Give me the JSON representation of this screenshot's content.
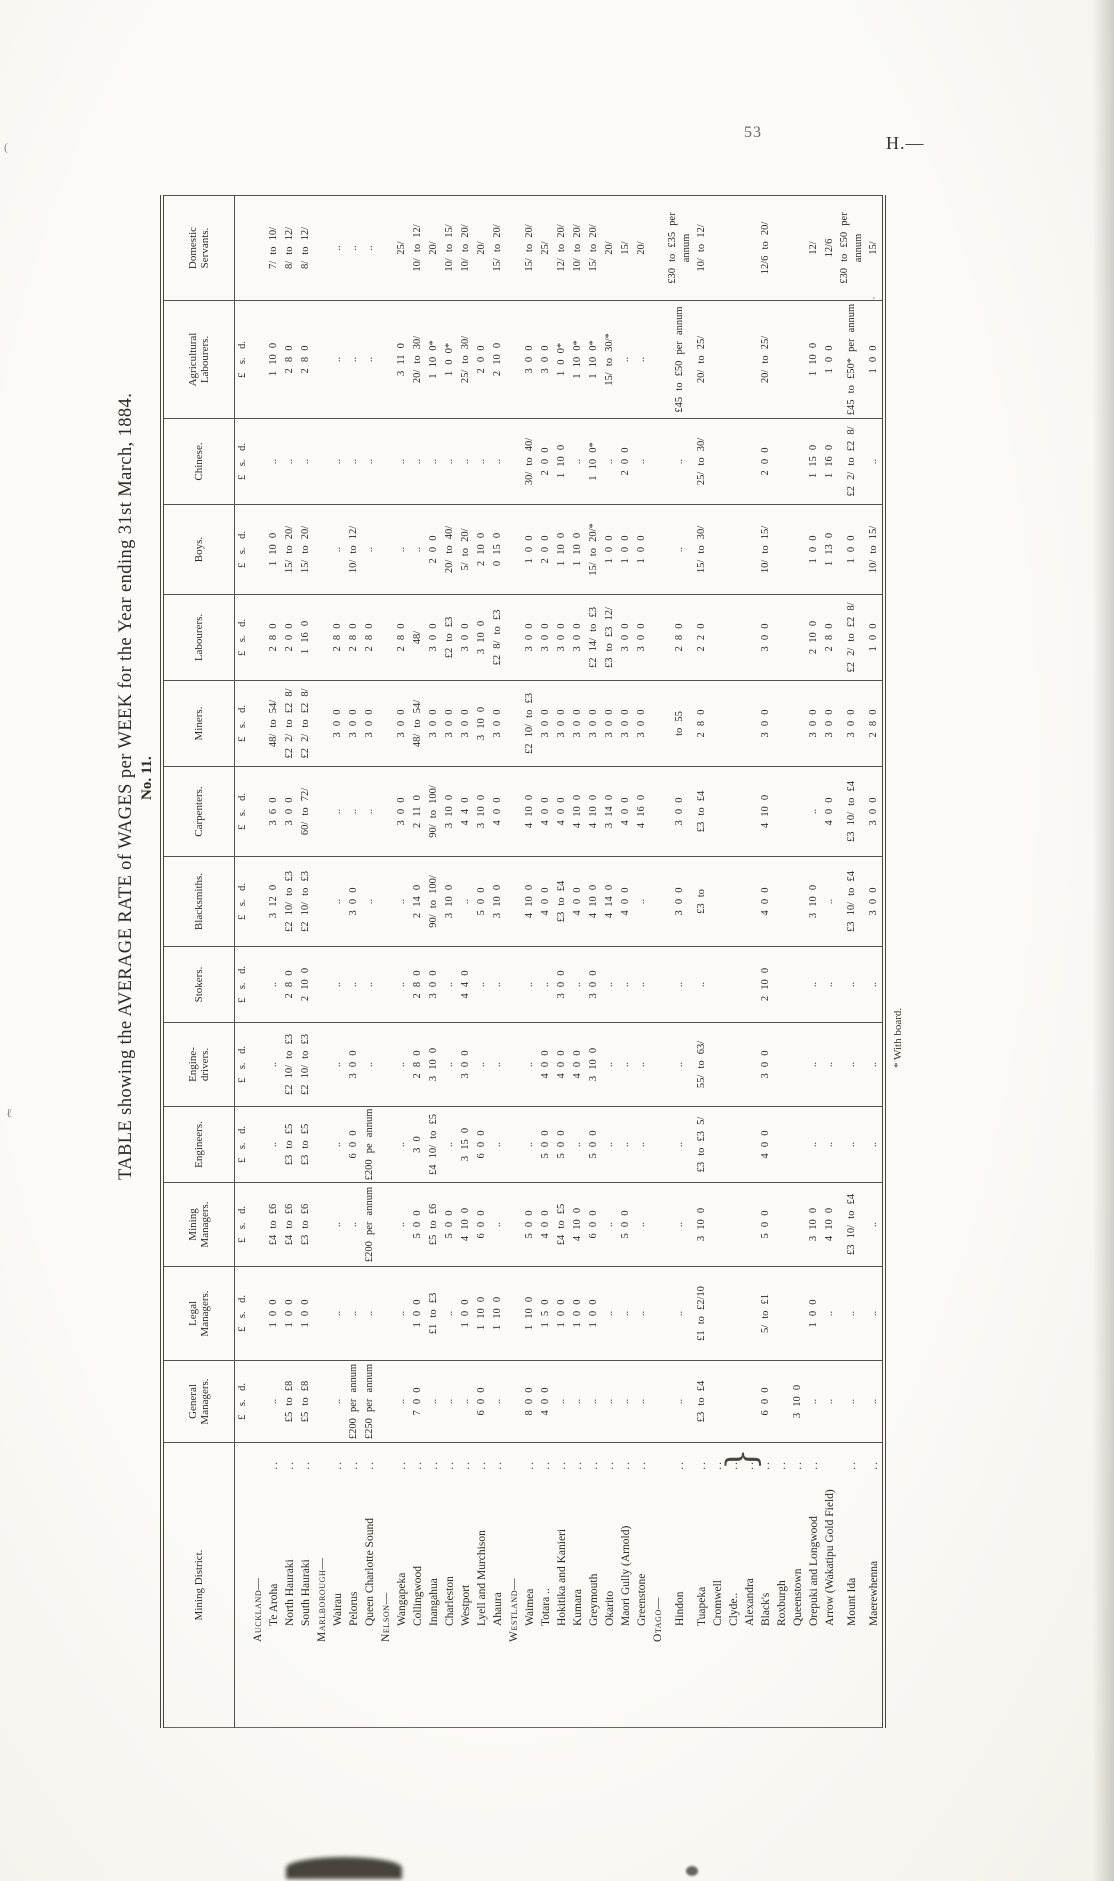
{
  "page": {
    "number": "53",
    "series_heading": "H.—",
    "footnote": "* With board."
  },
  "doc": {
    "table_no": "No. 11.",
    "title": "TABLE showing the AVERAGE RATE of WAGES per WEEK for the Year ending 31st March, 1884."
  },
  "table": {
    "columns": [
      {
        "label": "Mining District.",
        "sub": ""
      },
      {
        "label": "General\nManagers.",
        "sub": "£ s. d."
      },
      {
        "label": "Legal\nManagers.",
        "sub": "£ s. d."
      },
      {
        "label": "Mining\nManagers.",
        "sub": "£ s. d."
      },
      {
        "label": "Engineers.",
        "sub": "£ s. d."
      },
      {
        "label": "Engine-\ndrivers.",
        "sub": "£ s. d."
      },
      {
        "label": "Stokers.",
        "sub": "£ s. d."
      },
      {
        "label": "Blacksmiths.",
        "sub": "£ s. d."
      },
      {
        "label": "Carpenters.",
        "sub": "£ s. d."
      },
      {
        "label": "Miners.",
        "sub": "£ s. d."
      },
      {
        "label": "Labourers.",
        "sub": "£ s. d."
      },
      {
        "label": "Boys.",
        "sub": "£ s. d."
      },
      {
        "label": "Chinese.",
        "sub": "£ s. d."
      },
      {
        "label": "Agricultural\nLabourers.",
        "sub": "£ s. d."
      },
      {
        "label": "Domestic\nServants.",
        "sub": ""
      }
    ],
    "rows": [
      {
        "name": "Auckland—",
        "type": "section",
        "leader": "",
        "cells": [
          "",
          "",
          "",
          "",
          "",
          "",
          "",
          "",
          "",
          "",
          "",
          "",
          "",
          ""
        ]
      },
      {
        "name": "Te Aroha",
        "type": "district",
        "leader": "..",
        "cells": [
          "..",
          "1 0 0",
          "£4 to £6",
          "..",
          "..",
          "..",
          "3 12 0",
          "3 6 0",
          "48/ to 54/",
          "2 8 0",
          "1 10 0",
          "..",
          "1 10 0",
          "7/ to 10/"
        ]
      },
      {
        "name": "North Hauraki",
        "type": "district",
        "leader": "..",
        "cells": [
          "£5 to £8",
          "1 0 0",
          "£4 to £6",
          "£3 to £5",
          "£2 10/ to £3",
          "2 8 0",
          "£2 10/ to £3",
          "3 0 0",
          "£2 2/ to £2 8/",
          "2 0 0",
          "15/ to 20/",
          "..",
          "2 8 0",
          "8/ to 12/"
        ]
      },
      {
        "name": "South Hauraki",
        "type": "district",
        "leader": "..",
        "cells": [
          "£5 to £8",
          "1 0 0",
          "£3 to £6",
          "£3 to £5",
          "£2 10/ to £3",
          "2 10 0",
          "£2 10/ to £3",
          "60/ to 72/",
          "£2 2/ to £2 8/",
          "1 16 0",
          "15/ to 20/",
          "..",
          "2 8 0",
          "8/ to 12/"
        ]
      },
      {
        "name": "Marlborough—",
        "type": "section",
        "leader": "",
        "cells": [
          "",
          "",
          "",
          "",
          "",
          "",
          "",
          "",
          "",
          "",
          "",
          "",
          "",
          ""
        ]
      },
      {
        "name": "Wairau",
        "type": "district",
        "leader": "..",
        "cells": [
          "..",
          "..",
          "..",
          "..",
          "..",
          "..",
          "..",
          "..",
          "3 0 0",
          "2 8 0",
          "..",
          "..",
          "..",
          ".."
        ]
      },
      {
        "name": "Pelorus",
        "type": "district",
        "leader": "..",
        "cells": [
          "£200 per annum",
          "..",
          "..",
          "6 0 0",
          "3 0 0",
          "..",
          "3 0 0",
          "..",
          "3 0 0",
          "2 8 0",
          "10/ to 12/",
          "..",
          "..",
          ".."
        ]
      },
      {
        "name": "Queen Charlotte Sound",
        "type": "district",
        "leader": "..",
        "cells": [
          "£250 per annum",
          "..",
          "£200 per annum",
          "£200 pe annum",
          "..",
          "..",
          "..",
          "..",
          "3 0 0",
          "2 8 0",
          "..",
          "..",
          "..",
          ".."
        ]
      },
      {
        "name": "Nelson—",
        "type": "section",
        "leader": "",
        "cells": [
          "",
          "",
          "",
          "",
          "",
          "",
          "",
          "",
          "",
          "",
          "",
          "",
          "",
          ""
        ]
      },
      {
        "name": "Wangapeka",
        "type": "district",
        "leader": "..",
        "cells": [
          "..",
          "..",
          "..",
          "..",
          "..",
          "..",
          "..",
          "3 0 0",
          "3 0 0",
          "2 8 0",
          "..",
          "..",
          "3 11 0",
          "25/"
        ]
      },
      {
        "name": "Collingwood",
        "type": "district",
        "leader": "..",
        "cells": [
          "7 0 0",
          "1 0 0",
          "5 0 0",
          "3 0",
          "2 8 0",
          "2 8 0",
          "2 14 0",
          "2 11 0",
          "48/ to 54/",
          "48/",
          "..",
          "..",
          "20/ to 30/",
          "10/ to 12/"
        ]
      },
      {
        "name": "Inangahua",
        "type": "district",
        "leader": "..",
        "cells": [
          "..",
          "£1 to £3",
          "£5 to £6",
          "£4 10/ to £5",
          "3 10 0",
          "3 0 0",
          "90/ to 100/",
          "90/ to 100/",
          "3 0 0",
          "3 0 0",
          "2 0 0",
          "..",
          "1 10 0*",
          "20/"
        ]
      },
      {
        "name": "Charleston",
        "type": "district",
        "leader": "..",
        "cells": [
          "..",
          "..",
          "5 0 0",
          "..",
          "..",
          "..",
          "3 10 0",
          "3 10 0",
          "3 0 0",
          "£2 to £3",
          "20/ to 40/",
          "..",
          "1 0 0*",
          "10/ to 15/"
        ]
      },
      {
        "name": "Westport",
        "type": "district",
        "leader": "..",
        "cells": [
          "..",
          "1 0 0",
          "4 10 0",
          "3 15 0",
          "3 0 0",
          "4 4 0",
          "..",
          "4 4 0",
          "3 0 0",
          "3 0 0",
          "5/ to 20/",
          "..",
          "25/ to 30/",
          "10/ to 20/"
        ]
      },
      {
        "name": "Lyell and Murchison",
        "type": "district",
        "leader": "..",
        "cells": [
          "6 0 0",
          "1 10 0",
          "6 0 0",
          "6 0 0",
          "..",
          "..",
          "5 0 0",
          "3 10 0",
          "3 10 0",
          "3 10 0",
          "2 10 0",
          "..",
          "2 0 0",
          "20/"
        ]
      },
      {
        "name": "Ahaura",
        "type": "district",
        "leader": "..",
        "cells": [
          "..",
          "1 10 0",
          "..",
          "..",
          "..",
          "..",
          "3 10 0",
          "4 0 0",
          "3 0 0",
          "£2 8/ to £3",
          "0 15 0",
          "..",
          "2 10 0",
          "15/ to 20/"
        ]
      },
      {
        "name": "Westland—",
        "type": "section",
        "leader": "",
        "cells": [
          "",
          "",
          "",
          "",
          "",
          "",
          "",
          "",
          "",
          "",
          "",
          "",
          "",
          ""
        ]
      },
      {
        "name": "Waimea",
        "type": "district",
        "leader": "..",
        "cells": [
          "8 0 0",
          "1 10 0",
          "5 0 0",
          "..",
          "..",
          "..",
          "4 10 0",
          "4 10 0",
          "£2 10/ to £3",
          "3 0 0",
          "1 0 0",
          "30/ to 40/",
          "3 0 0",
          "15/ to 20/"
        ]
      },
      {
        "name": "Totara ..",
        "type": "district",
        "leader": "..",
        "cells": [
          "4 0 0",
          "1 5 0",
          "4 0 0",
          "5 0 0",
          "4 0 0",
          "..",
          "4 0 0",
          "4 0 0",
          "3 0 0",
          "3 0 0",
          "2 0 0",
          "2 0 0",
          "3 0 0",
          "25/"
        ]
      },
      {
        "name": "Hokitika and Kanieri",
        "type": "district",
        "leader": "..",
        "cells": [
          "..",
          "1 0 0",
          "£4 to £5",
          "5 0 0",
          "4 0 0",
          "3 0 0",
          "£3 to £4",
          "4 0 0",
          "3 0 0",
          "3 0 0",
          "1 10 0",
          "1 10 0",
          "1 0 0*",
          "12/ to 20/"
        ]
      },
      {
        "name": "Kumara",
        "type": "district",
        "leader": "..",
        "cells": [
          "..",
          "1 0 0",
          "4 10 0",
          "..",
          "4 0 0",
          "..",
          "4 0 0",
          "4 10 0",
          "3 0 0",
          "3 0 0",
          "1 10 0",
          "..",
          "1 10 0*",
          "10/ to 20/"
        ]
      },
      {
        "name": "Greymouth",
        "type": "district",
        "leader": "..",
        "cells": [
          "..",
          "1 0 0",
          "6 0 0",
          "5 0 0",
          "3 10 0",
          "3 0 0",
          "4 10 0",
          "4 10 0",
          "3 0 0",
          "£2 14/ to £3",
          "15/ to 20/*",
          "1 10 0*",
          "1 10 0*",
          "15/ to 20/"
        ]
      },
      {
        "name": "Okarito",
        "type": "district",
        "leader": "..",
        "cells": [
          "..",
          "..",
          "..",
          "..",
          "..",
          "..",
          "4 14 0",
          "3 14 0",
          "3 0 0",
          "£3 to £3 12/",
          "1 0 0",
          "..",
          "15/ to 30/*",
          "20/"
        ]
      },
      {
        "name": "Maori Gully (Arnold)",
        "type": "district",
        "leader": "..",
        "cells": [
          "..",
          "..",
          "5 0 0",
          "..",
          "..",
          "..",
          "4 0 0",
          "4 0 0",
          "3 0 0",
          "3 0 0",
          "1 0 0",
          "2 0 0",
          "..",
          "15/"
        ]
      },
      {
        "name": "Greenstone",
        "type": "district",
        "leader": "..",
        "cells": [
          "..",
          "..",
          "..",
          "..",
          "..",
          "..",
          "..",
          "4 16 0",
          "3 0 0",
          "3 0 0",
          "1 0 0",
          "..",
          "..",
          "20/"
        ]
      },
      {
        "name": "Otago—",
        "type": "section",
        "leader": "",
        "cells": [
          "",
          "",
          "",
          "",
          "",
          "",
          "",
          "",
          "",
          "",
          "",
          "",
          "",
          ""
        ]
      },
      {
        "name": "Hindon",
        "type": "district",
        "leader": "..",
        "cells": [
          "..",
          "..",
          "..",
          "..",
          "..",
          "..",
          "3 0 0",
          "3 0 0",
          "to 55",
          "2 8 0",
          "..",
          "..",
          "£45 to £50 per annum",
          "£30 to £35 per annum"
        ]
      },
      {
        "name": "Tuapeka",
        "type": "district",
        "leader": "..",
        "cells": [
          "£3 to £4",
          "£1 to £2/10",
          "3 10 0",
          "£3 to £3 5/",
          "55/ to 63/",
          "..",
          "£3 to",
          "£3 to £4",
          "2 8 0",
          "2 2 0",
          "15/ to 30/",
          "25/ to 30/",
          "20/ to 25/",
          "10/ to 12/"
        ]
      },
      {
        "name": "Cromwell",
        "type": "district",
        "leader": "..",
        "cells": [
          "",
          "",
          "",
          "",
          "",
          "",
          "",
          "",
          "",
          "",
          "",
          "",
          "",
          ""
        ]
      },
      {
        "name": "Clyde..",
        "type": "district",
        "leader": "..",
        "cells": [
          "",
          "",
          "",
          "",
          "",
          "",
          "",
          "",
          "",
          "",
          "",
          "",
          "",
          ""
        ]
      },
      {
        "name": "Alexandra",
        "type": "district",
        "leader": "..",
        "cells": [
          "",
          "",
          "",
          "",
          "",
          "",
          "",
          "",
          "",
          "",
          "",
          "",
          "",
          ""
        ]
      },
      {
        "name": "Black's",
        "type": "district",
        "leader": "..",
        "cells": [
          "6 0 0",
          "5/ to £1",
          "5 0 0",
          "4 0 0",
          "3 0 0",
          "2 10 0",
          "4 0 0",
          "4 10 0",
          "3 0 0",
          "3 0 0",
          "10/ to 15/",
          "2 0 0",
          "20/ to 25/",
          "12/6 to 20/"
        ]
      },
      {
        "name": "Roxburgh",
        "type": "district",
        "leader": "..",
        "cells": [
          "",
          "",
          "",
          "",
          "",
          "",
          "",
          "",
          "",
          "",
          "",
          "",
          "",
          ""
        ]
      },
      {
        "name": "Queenstown",
        "type": "district",
        "leader": "..",
        "cells": [
          "3 10 0",
          "",
          "",
          "",
          "",
          "",
          "",
          "",
          "",
          "",
          "",
          "",
          "",
          ""
        ]
      },
      {
        "name": "Orepuki and Longwood",
        "type": "district",
        "leader": "..",
        "cells": [
          "..",
          "1 0 0",
          "3 10 0",
          "..",
          "..",
          "..",
          "3 10 0",
          "..",
          "3 0 0",
          "2 10 0",
          "1 0 0",
          "1 15 0",
          "1 10 0",
          "12/"
        ]
      },
      {
        "name": "Arrow (Wakatipu Gold Field)",
        "type": "district",
        "leader": "",
        "cells": [
          "..",
          "..",
          "4 10 0",
          "..",
          "..",
          "..",
          "..",
          "4 0 0",
          "3 0 0",
          "2 8 0",
          "1 13 0",
          "1 16 0",
          "1 0 0",
          "12/6"
        ]
      },
      {
        "name": "Mount Ida",
        "type": "district",
        "leader": "..",
        "cells": [
          "..",
          "..",
          "£3 10/ to £4",
          "..",
          "..",
          "..",
          "£3 10/ to £4",
          "£3 10/ to £4",
          "3 0 0",
          "£2 2/ to £2 8/",
          "1 0 0",
          "£2 2/ to £2 8/",
          "£45 to £50* per annum",
          "£30 to £50 per annum"
        ]
      },
      {
        "name": "Maerewhenna",
        "type": "district",
        "leader": "..",
        "cells": [
          "..",
          "..",
          "..",
          "..",
          "..",
          "..",
          "3 0 0",
          "3 0 0",
          "2 8 0",
          "1 0 0",
          "10/ to 15/",
          "..",
          "1 0 0",
          "15/"
        ]
      }
    ]
  }
}
